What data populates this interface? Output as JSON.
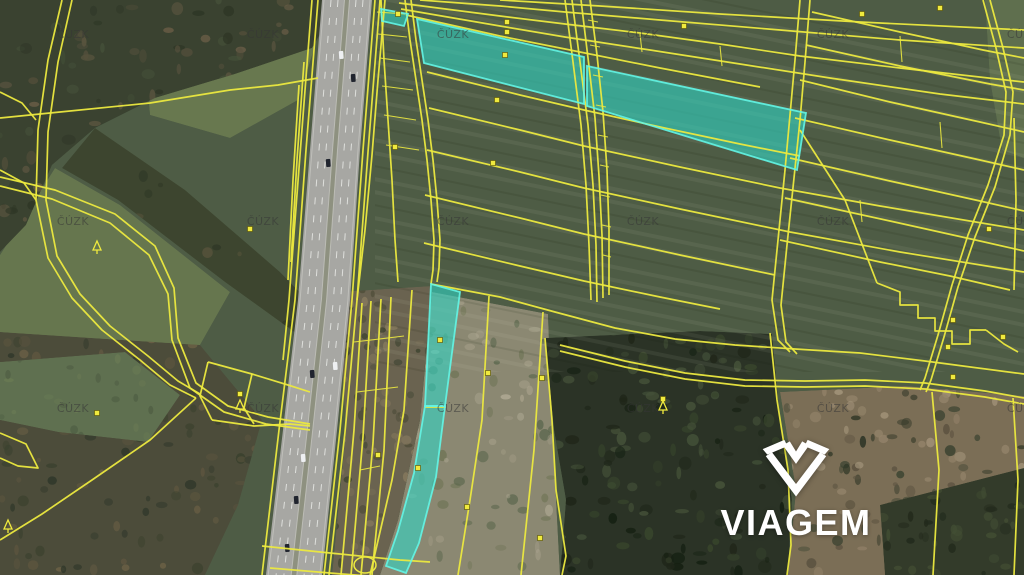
{
  "map": {
    "source_watermark_text": "ČÚZK",
    "watermark_columns_x": [
      73,
      263,
      453,
      643,
      833,
      1023
    ],
    "watermark_rows_y": [
      38,
      225,
      412
    ],
    "colors": {
      "parcel_boundary": "#ece93f",
      "highlight_fill": "#2fd9c8",
      "highlight_stroke": "#63f5e6",
      "watermark_text": "rgba(55,55,55,0.55)",
      "marker_fill": "#f0ea3e",
      "marker_stroke": "rgba(95,88,10,0.85)",
      "road_surface": "#a7a7a3",
      "road_median": "#8e9180",
      "lane_marking": "#eceeea"
    },
    "highlighted_parcels": [
      {
        "id": "north-strip",
        "pieces": [
          "381,9 408,14 404,26 382,21",
          "417,19 584,57 584,104 424,63",
          "587,66 806,113 797,170 587,106"
        ]
      },
      {
        "id": "south-strip",
        "pieces": [
          "431,284 460,292 445,406 425,406",
          "425,406 445,406 436,477 419,543 406,573 386,566 398,531 414,473"
        ]
      }
    ],
    "parcel_markers": [
      [
        398,
        14
      ],
      [
        507,
        22
      ],
      [
        507,
        32
      ],
      [
        505,
        55
      ],
      [
        497,
        100
      ],
      [
        395,
        147
      ],
      [
        493,
        163
      ],
      [
        684,
        26
      ],
      [
        862,
        14
      ],
      [
        940,
        8
      ],
      [
        989,
        229
      ],
      [
        953,
        320
      ],
      [
        1003,
        337
      ],
      [
        948,
        347
      ],
      [
        953,
        377
      ],
      [
        440,
        340
      ],
      [
        488,
        373
      ],
      [
        542,
        378
      ],
      [
        378,
        455
      ],
      [
        418,
        468
      ],
      [
        467,
        507
      ],
      [
        540,
        538
      ],
      [
        97,
        413
      ],
      [
        250,
        229
      ],
      [
        240,
        394
      ],
      [
        663,
        399
      ]
    ],
    "tree_symbols": [
      [
        97,
        248
      ],
      [
        240,
        407
      ],
      [
        663,
        408
      ],
      [
        8,
        527
      ]
    ],
    "vehicles": {
      "dark": [
        [
          353,
          78
        ],
        [
          328,
          163
        ],
        [
          312,
          374
        ],
        [
          296,
          500
        ],
        [
          287,
          548
        ]
      ],
      "light": [
        [
          341,
          55
        ],
        [
          335,
          366
        ],
        [
          303,
          458
        ]
      ]
    }
  },
  "branding": {
    "logo_text": "VIAGEM",
    "logo_icon": "viagem-gem-icon",
    "logo_color": "#ffffff"
  }
}
